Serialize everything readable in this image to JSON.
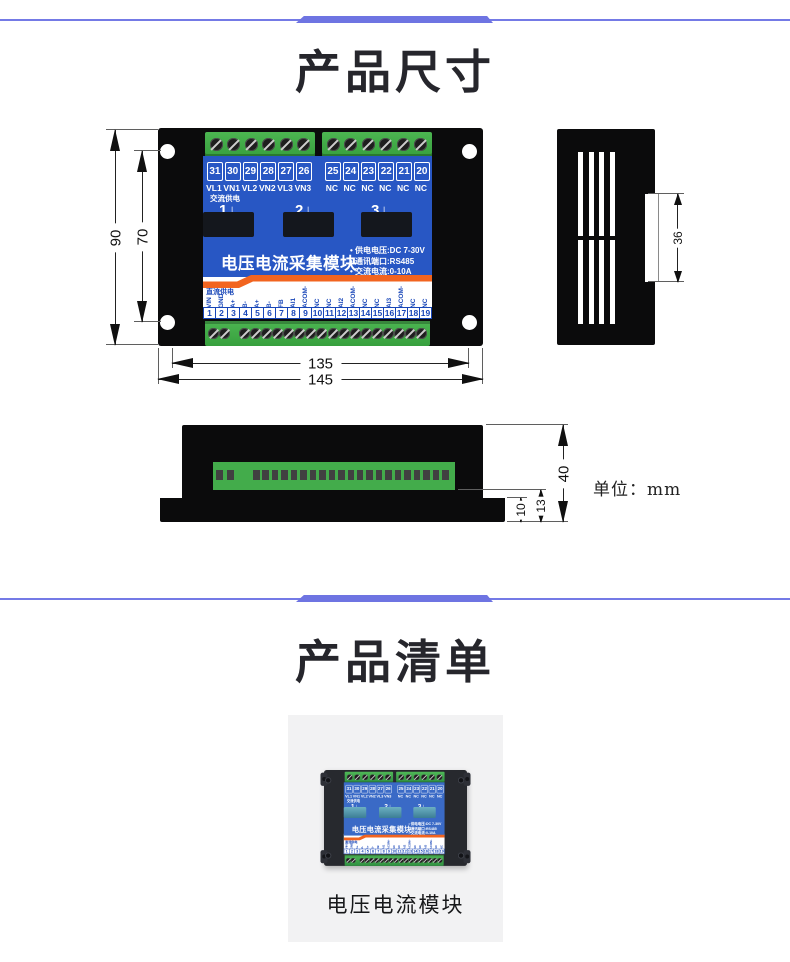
{
  "section_dimensions": {
    "title": "产品尺寸",
    "unit_label": "单位：mm",
    "dims": {
      "body_height": "90",
      "hole_pitch_v": "70",
      "width_inner": "135",
      "width_outer": "145",
      "side_slot": "36",
      "depth": "40",
      "connector_depth": "13",
      "flange_depth": "10"
    }
  },
  "device": {
    "name": "电压电流采集模块",
    "ac_supply_label": "交流供电",
    "dc_supply_label": "直流供电",
    "channel_markers": [
      "1",
      "2",
      "3"
    ],
    "down_arrow_icon": "↓",
    "specs": [
      "• 供电电压:DC 7-30V",
      "• 通讯端口:RS485",
      "• 交流电流:0-10A"
    ],
    "top_terminal_numbers": [
      "31",
      "30",
      "29",
      "28",
      "27",
      "26",
      "25",
      "24",
      "23",
      "22",
      "21",
      "20"
    ],
    "top_terminal_labels": [
      "VL1",
      "VN1",
      "VL2",
      "VN2",
      "VL3",
      "VN3",
      "NC",
      "NC",
      "NC",
      "NC",
      "NC",
      "NC"
    ],
    "bottom_terminal_labels": [
      "VIN",
      "GND",
      "A+",
      "B-",
      "A+",
      "B-",
      "FB",
      "AI1",
      "ACOM-",
      "NC",
      "NC",
      "AI2",
      "ACOM-",
      "NC",
      "NC",
      "AI3",
      "ACOM-",
      "NC",
      "NC"
    ],
    "bottom_terminal_numbers": [
      "1",
      "2",
      "3",
      "4",
      "5",
      "6",
      "7",
      "8",
      "9",
      "10",
      "11",
      "12",
      "13",
      "14",
      "15",
      "16",
      "17",
      "18",
      "19"
    ]
  },
  "section_list": {
    "title": "产品清单",
    "item_caption": "电压电流模块"
  },
  "colors": {
    "accent_divider": "#6e74e2",
    "panel_blue": "#2857c4",
    "stripe_orange": "#f2641f",
    "terminal_green": "#43ac4b",
    "label_blue": "#1846b8"
  }
}
